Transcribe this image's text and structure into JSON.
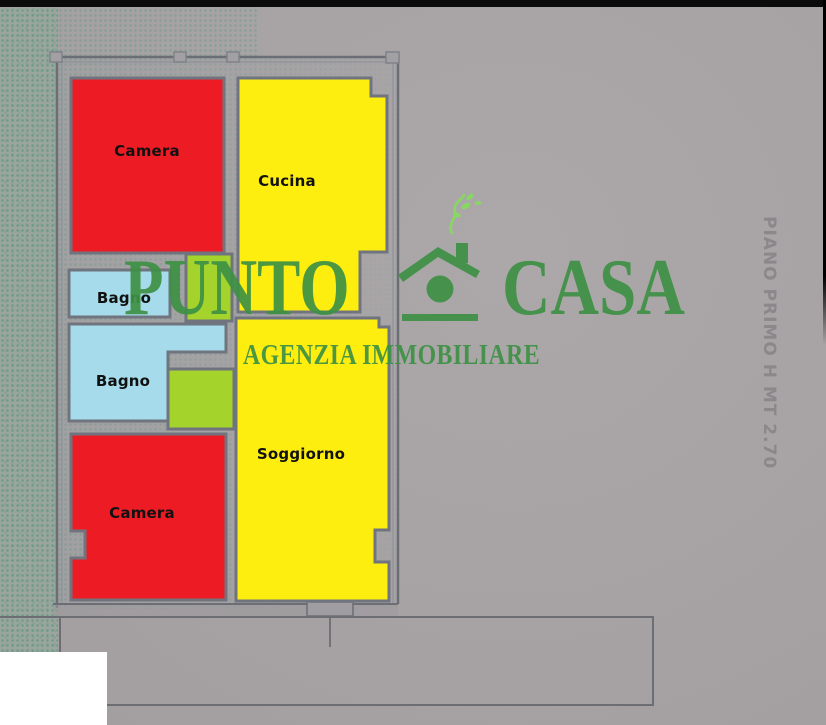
{
  "floor_plan": {
    "side_note": "PIANO PRIMO H MT 2.70",
    "rooms": {
      "camera_top": {
        "label": "Camera"
      },
      "cucina": {
        "label": "Cucina"
      },
      "bagno_small": {
        "label": "Bagno"
      },
      "bagno_large": {
        "label": "Bagno"
      },
      "camera_bottom": {
        "label": "Camera"
      },
      "soggiorno": {
        "label": "Soggiorno"
      },
      "corridor_top": {
        "label": ""
      },
      "storage_mid": {
        "label": ""
      }
    }
  },
  "watermark": {
    "brand_first": "PUNTO",
    "brand_second": "CASA",
    "tagline": "AGENZIA IMMOBILIARE",
    "house_icon": "house-with-chimney-icon"
  },
  "colors": {
    "room_red": "#ed1c24",
    "room_yellow": "#fdee10",
    "room_blue": "#a5dbea",
    "room_lime": "#a4d32b",
    "logo_green": "#3e9145",
    "smoke_green": "#85dd5c",
    "wall_gray": "#70747e",
    "line_gray": "#6b6e75",
    "paper_gray": "#a8a4a6",
    "side_text_gray": "#8b878b",
    "label_black": "#111111"
  }
}
